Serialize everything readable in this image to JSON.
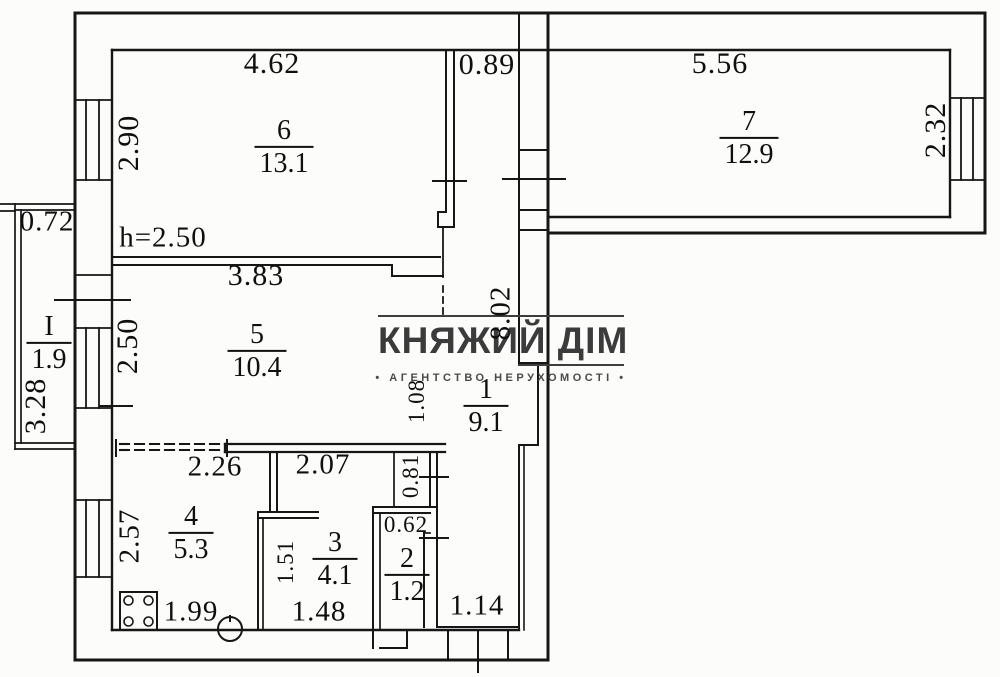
{
  "watermark": {
    "brand": "КНЯЖИЙ ДІМ",
    "tagline": "• АГЕНТСТВО НЕРУХОМОСТІ •"
  },
  "rooms": {
    "room6": {
      "number": "6",
      "area": "13.1"
    },
    "room7": {
      "number": "7",
      "area": "12.9"
    },
    "room5": {
      "number": "5",
      "area": "10.4"
    },
    "room1": {
      "number": "1",
      "area": "9.1"
    },
    "room4": {
      "number": "4",
      "area": "5.3"
    },
    "room3": {
      "number": "3",
      "area": "4.1"
    },
    "room2": {
      "number": "2",
      "area": "1.2"
    },
    "balcony": {
      "number": "I",
      "area": "1.9"
    }
  },
  "dimensions": {
    "room6_width": "4.62",
    "hall_top_width": "0.89",
    "room7_width": "5.56",
    "room6_height": "2.90",
    "room7_height": "2.32",
    "balcony_width": "0.72",
    "ceiling_height": "h=2.50",
    "room5_width": "3.83",
    "room5_height": "2.50",
    "balcony_length": "3.28",
    "total_inner_length": "8.02",
    "hall_niche_width": "1.08",
    "room4_opening": "2.26",
    "hall_bottom_width": "2.07",
    "niche_height": "0.81",
    "room4_height": "2.57",
    "room3_height": "1.51",
    "room2_width": "0.62",
    "room4_width": "1.99",
    "room3_width": "1.48",
    "corridor_width": "1.14"
  }
}
